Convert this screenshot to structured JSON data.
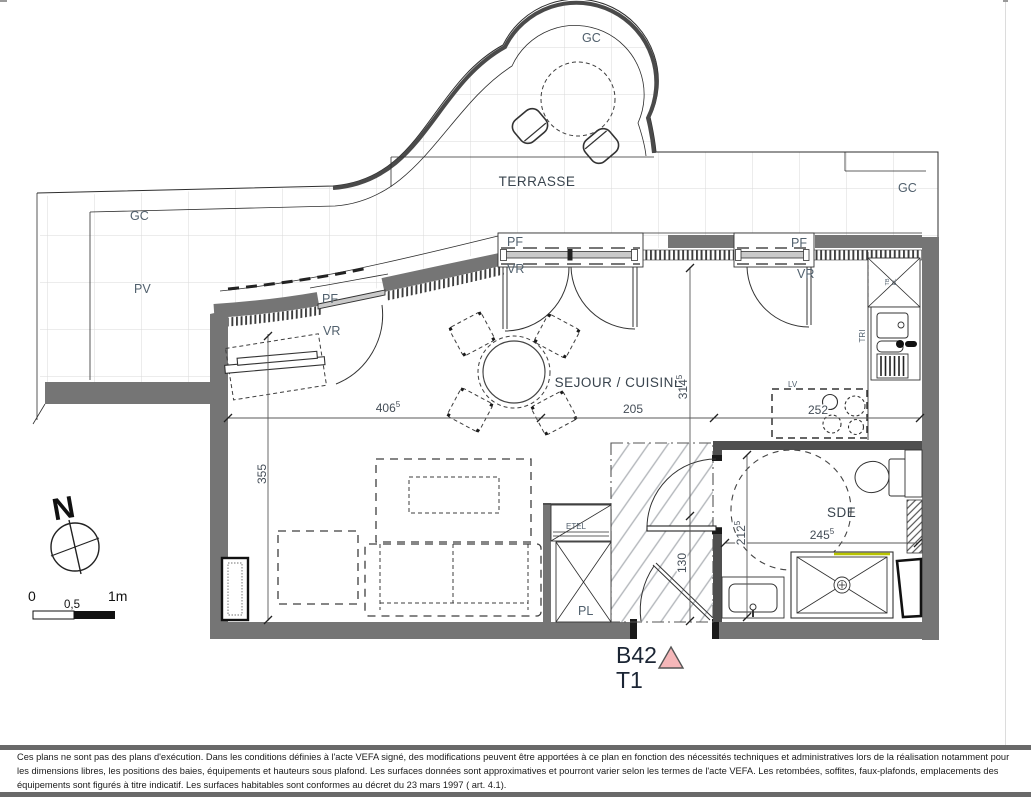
{
  "plan": {
    "unit": {
      "number": "B42",
      "type": "T1"
    },
    "rooms": {
      "terrasse": "TERRASSE",
      "sejour": "SEJOUR / CUISINE",
      "sde": "SDE"
    },
    "labels": {
      "gc": "GC",
      "pv": "PV",
      "pf": "PF",
      "vr": "VR",
      "tri": "TRI",
      "lv": "LV",
      "etel": "ETEL",
      "pl": "PL",
      "tb": "TB",
      "el": "EL"
    },
    "dimensions": {
      "d406": {
        "v": "406",
        "s": "5"
      },
      "d205": {
        "v": "205",
        "s": ""
      },
      "d314": {
        "v": "314",
        "s": "5"
      },
      "d355": {
        "v": "355",
        "s": ""
      },
      "d252": {
        "v": "252",
        "s": ""
      },
      "d212": {
        "v": "212",
        "s": "5"
      },
      "d245": {
        "v": "245",
        "s": "5"
      },
      "d130": {
        "v": "130",
        "s": ""
      }
    },
    "compass": {
      "north": "N"
    },
    "scalebar": {
      "zero": "0",
      "half": "0,5",
      "one": "1m"
    },
    "colors": {
      "wall": "#757575",
      "label": "#51606d",
      "room": "#39444e",
      "dim": "#454e58",
      "triangle": "#f5b7b9",
      "accent_yellow": "#b9c400",
      "unit_text": "#1b2534"
    }
  },
  "footer": {
    "disclaimer": "Ces plans ne sont pas des plans d'exécution. Dans les conditions définies à l'acte VEFA signé, des modifications peuvent être apportées à ce plan en fonction des nécessités techniques et administratives lors de la réalisation notamment pour les dimensions libres, les positions des baies, équipements et hauteurs sous plafond. Les surfaces données sont approximatives et pourront varier selon les termes de l'acte VEFA. Les retombées, soffites, faux-plafonds, emplacements des équipements sont figurés à titre indicatif. Les surfaces habitables sont conformes au décret du 23 mars 1997 ( art. 4.1)."
  }
}
